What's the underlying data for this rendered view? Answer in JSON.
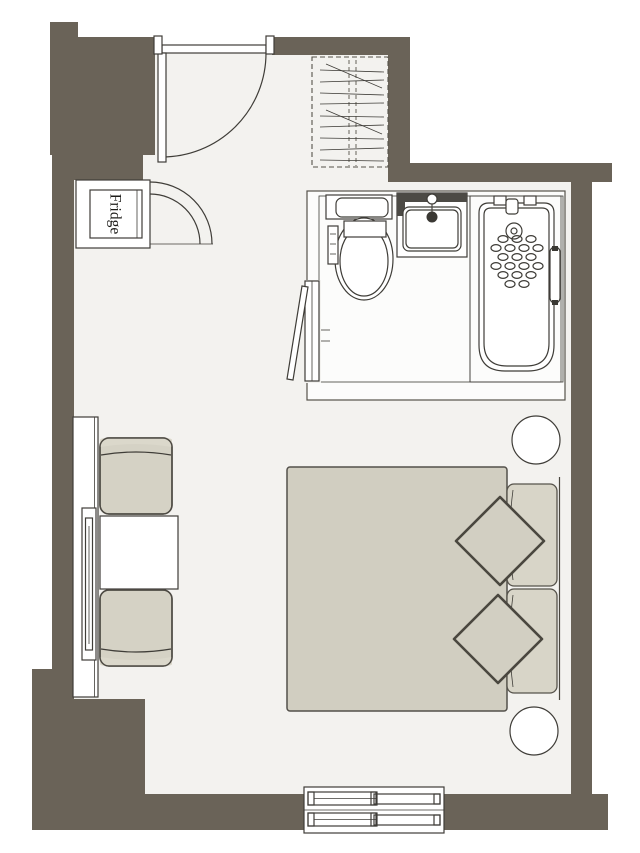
{
  "title": "room-floor-plan",
  "labels": {
    "fridge": "Fridge",
    "tv": "TV"
  },
  "colors": {
    "wall": "#6a6358",
    "floor": "#f3f2ef",
    "bath_floor": "#fcfcfb",
    "outline": "#4a473f",
    "fixture": "#3f3d38",
    "furniture": "#d5d2c5",
    "furniture_light": "#dbd8cb",
    "duvet": "#d1cec1",
    "pillow": "#d8d5c8",
    "cushion": "#d2cfc2",
    "white": "#ffffff"
  }
}
